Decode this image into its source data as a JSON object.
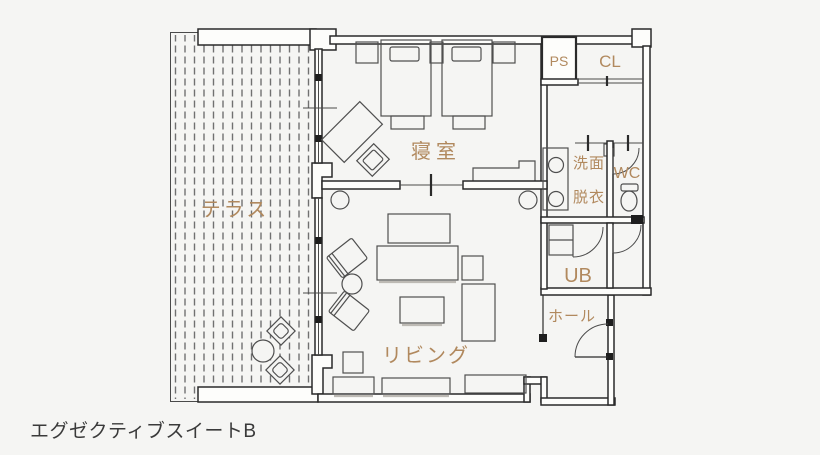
{
  "palette": {
    "background": "#f5f5f3",
    "wall_line": "#2a2a2a",
    "furniture_line": "#4f4f4f",
    "hatch": "#707070",
    "label": "#b1895e",
    "caption": "#3a3a3a"
  },
  "plan": {
    "labels": {
      "terrace": "テラス",
      "bedroom": "寝室",
      "living": "リビング",
      "ps": "PS",
      "cl": "CL",
      "washroom_1": "洗面",
      "washroom_2": "脱衣",
      "wc": "WC",
      "unit_bath": "UB",
      "hall": "ホール"
    }
  },
  "caption": "エグゼクティブスイートB"
}
